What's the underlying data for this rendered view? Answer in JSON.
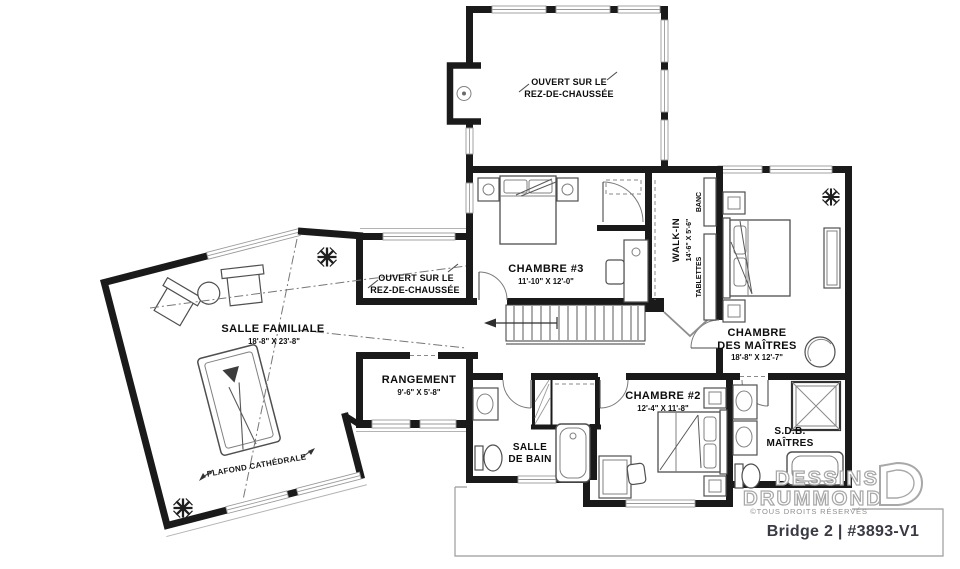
{
  "plan": {
    "rooms": {
      "ouvert_top": {
        "line1": "OUVERT SUR LE",
        "line2": "REZ-DE-CHAUSSÉE"
      },
      "ouvert_mid": {
        "line1": "OUVERT SUR LE",
        "line2": "REZ-DE-CHAUSSÉE"
      },
      "chambre3": {
        "name": "CHAMBRE #3",
        "dims": "11'-10\" X 12'-0\""
      },
      "walkin": {
        "name": "WALK-IN",
        "dims": "14'-6\" X 5'-6\""
      },
      "banc": "BANC",
      "tablettes": "TABLETTES",
      "chambre_maitres": {
        "line1": "CHAMBRE",
        "line2": "DES MAÎTRES",
        "dims": "18'-8\" X 12'-7\""
      },
      "salle_familiale": {
        "name": "SALLE FAMILIALE",
        "dims": "18'-8\" X 23'-8\""
      },
      "rangement": {
        "name": "RANGEMENT",
        "dims": "9'-6\" X 5'-8\""
      },
      "chambre2": {
        "name": "CHAMBRE #2",
        "dims": "12'-4\" X 11'-8\""
      },
      "salle_de_bain": {
        "line1": "SALLE",
        "line2": "DE BAIN"
      },
      "sdb_maitres": {
        "line1": "S.D.B.",
        "line2": "MAÎTRES"
      },
      "plafond_cathedrale": "PLAFOND CATHÉDRALE"
    },
    "branding": {
      "name_line1": "DESSINS",
      "name_line2": "DRUMMOND",
      "rights": "©TOUS DROITS RÉSERVÉS",
      "plan_title": "Bridge 2 | #3893-V1"
    },
    "colors": {
      "wall": "#1a1a1a",
      "furniture": "#4f4f4f",
      "logo": "#a8a8a8"
    }
  }
}
